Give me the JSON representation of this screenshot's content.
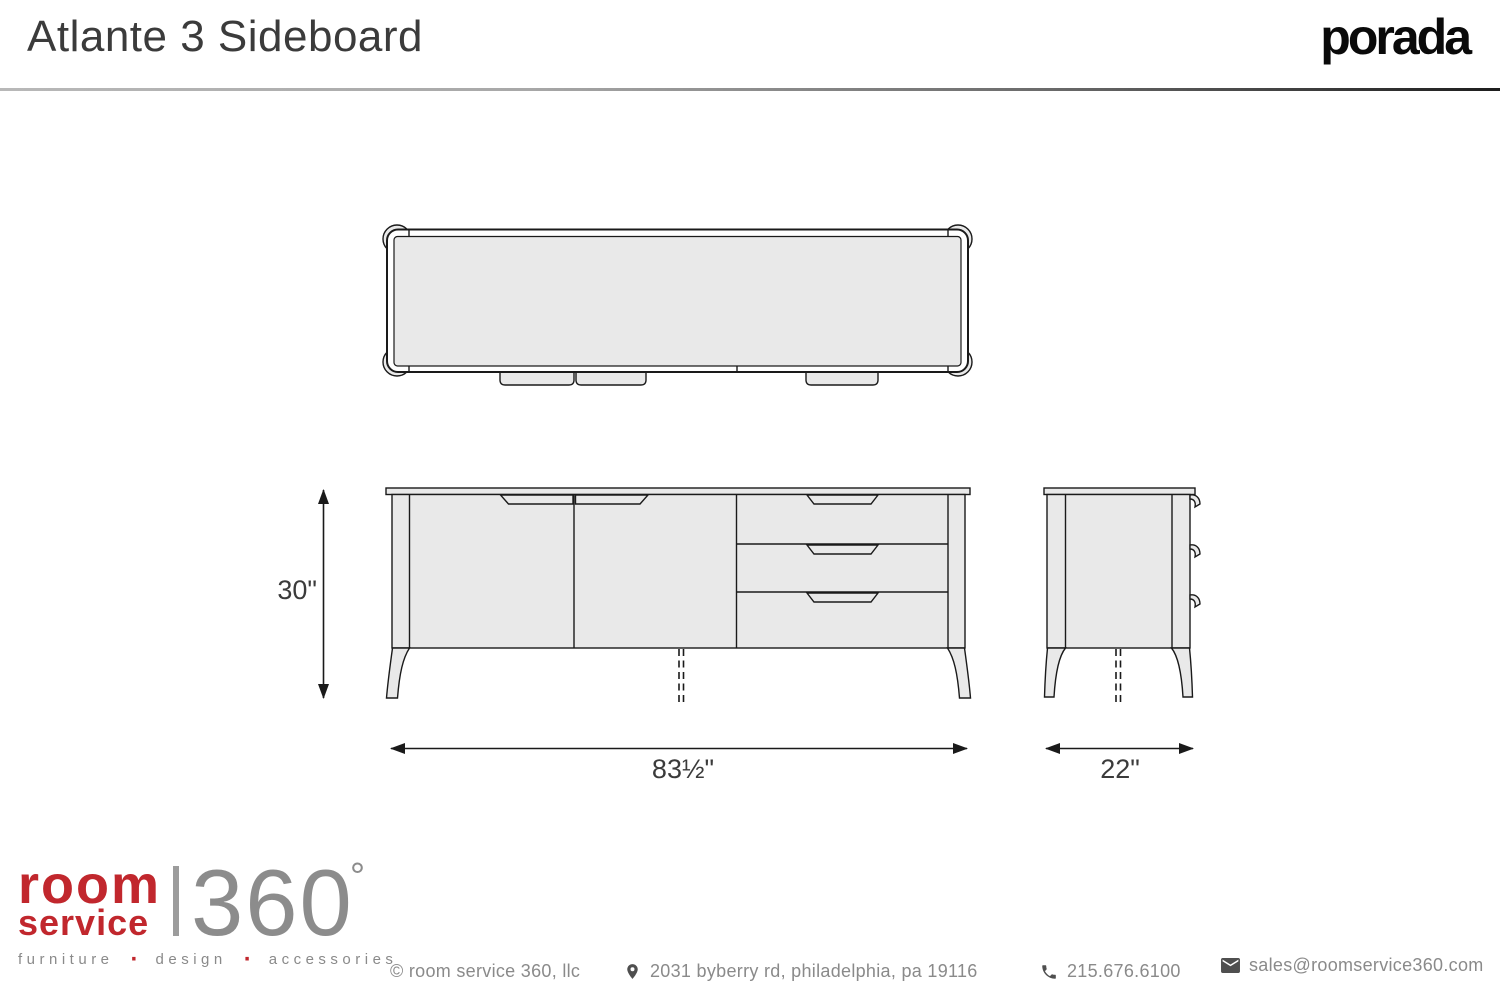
{
  "header": {
    "title": "Atlante 3 Sideboard",
    "brand_logo": "porada"
  },
  "drawing": {
    "dimensions": {
      "height": "30\"",
      "width": "83½\"",
      "depth": "22\""
    }
  },
  "footer": {
    "logo": {
      "line1": "room",
      "line2": "service",
      "number": "360",
      "degree": "°",
      "tagline_words": [
        "furniture",
        "design",
        "accessories"
      ],
      "tagline_separator": "·"
    },
    "copyright": "© room service 360, llc",
    "address": "2031 byberry rd, philadelphia, pa 19116",
    "phone": "215.676.6100",
    "email": "sales@roomservice360.com"
  },
  "colors": {
    "brand_red": "#c1272d",
    "text_gray": "#8a8a8a",
    "drawing_fill": "#e9e9e9",
    "drawing_line": "#1a1a1a",
    "title_color": "#3b3b3b"
  }
}
